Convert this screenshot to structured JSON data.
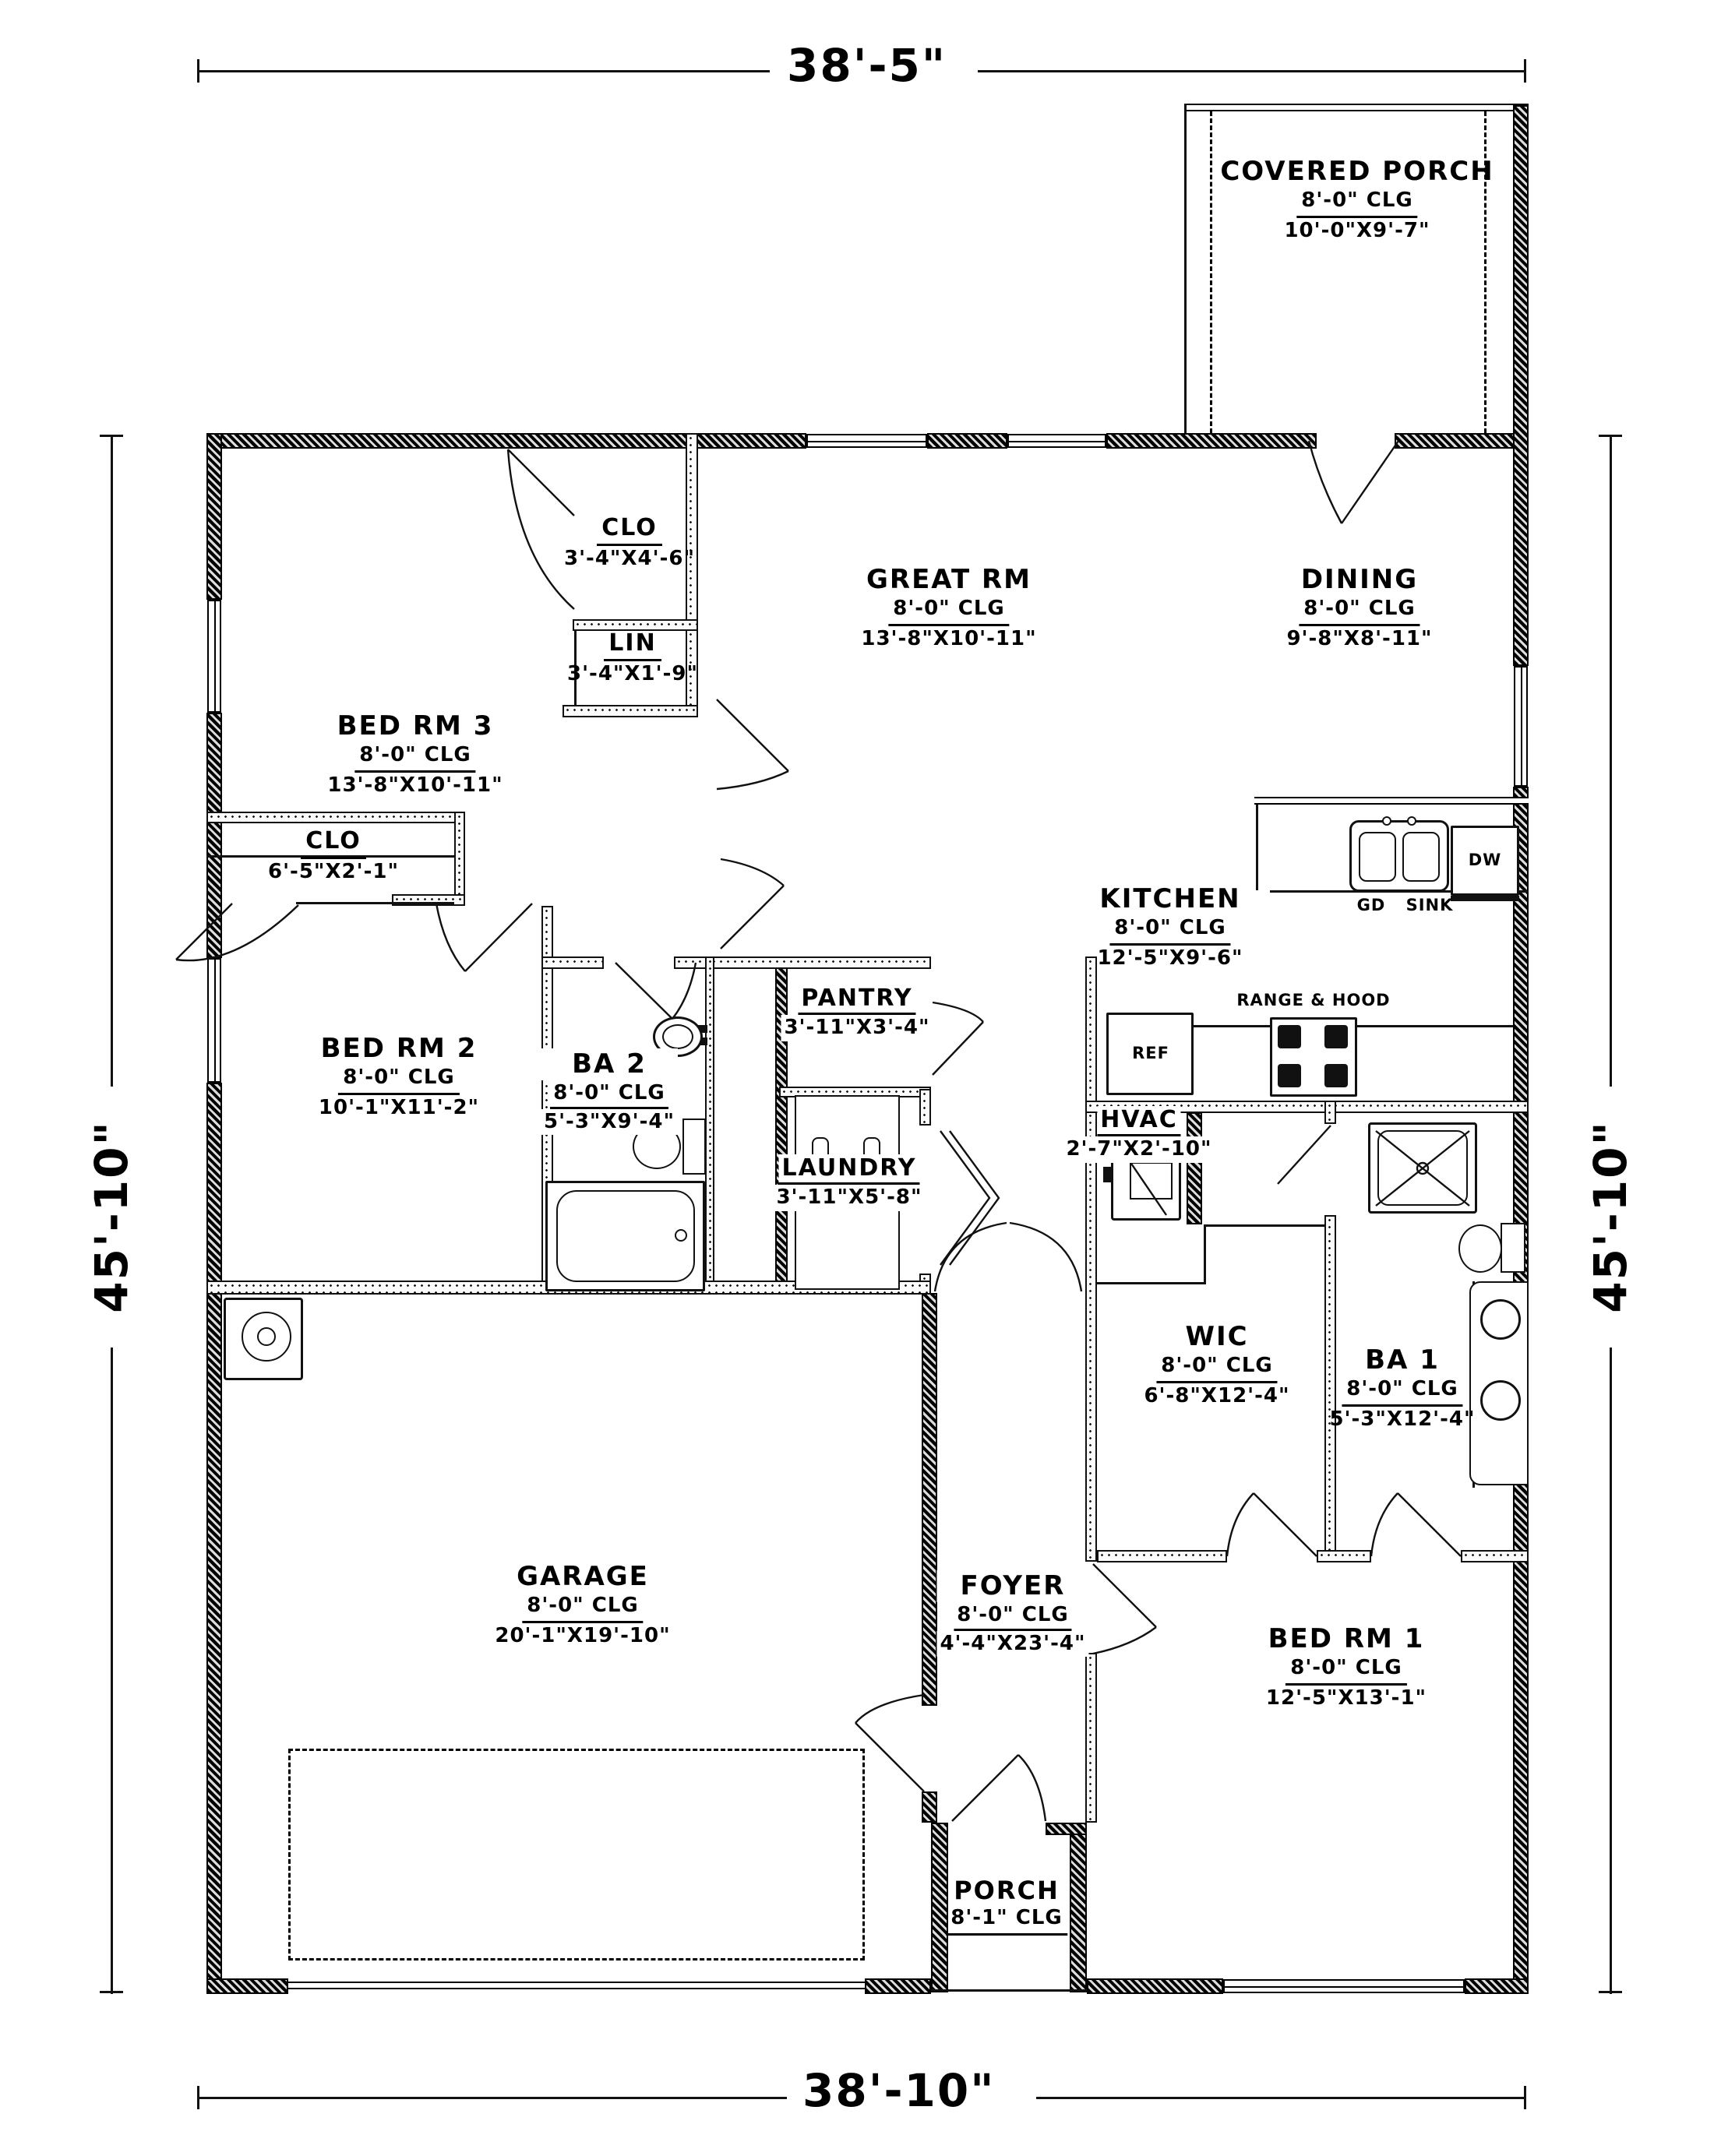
{
  "dimensions": {
    "top": "38'-5\"",
    "bottom": "38'-10\"",
    "left": "45'-10\"",
    "right": "45'-10\""
  },
  "rooms": {
    "covered_porch": {
      "name": "COVERED PORCH",
      "clg": "8'-0\" CLG",
      "size": "10'-0\"X9'-7\""
    },
    "great_rm": {
      "name": "GREAT RM",
      "clg": "8'-0\" CLG",
      "size": "13'-8\"X10'-11\""
    },
    "dining": {
      "name": "DINING",
      "clg": "8'-0\" CLG",
      "size": "9'-8\"X8'-11\""
    },
    "clo_top": {
      "name": "CLO",
      "size": "3'-4\"X4'-6\""
    },
    "lin": {
      "name": "LIN",
      "size": "3'-4\"X1'-9\""
    },
    "bed_rm_3": {
      "name": "BED RM 3",
      "clg": "8'-0\" CLG",
      "size": "13'-8\"X10'-11\""
    },
    "clo_2": {
      "name": "CLO",
      "size": "6'-5\"X2'-1\""
    },
    "bed_rm_2": {
      "name": "BED RM 2",
      "clg": "8'-0\" CLG",
      "size": "10'-1\"X11'-2\""
    },
    "ba_2": {
      "name": "BA 2",
      "clg": "8'-0\" CLG",
      "size": "5'-3\"X9'-4\""
    },
    "pantry": {
      "name": "PANTRY",
      "size": "3'-11\"X3'-4\""
    },
    "laundry": {
      "name": "LAUNDRY",
      "size": "3'-11\"X5'-8\""
    },
    "kitchen": {
      "name": "KITCHEN",
      "clg": "8'-0\" CLG",
      "size": "12'-5\"X9'-6\""
    },
    "hvac": {
      "name": "HVAC",
      "size": "2'-7\"X2'-10\""
    },
    "wic": {
      "name": "WIC",
      "clg": "8'-0\" CLG",
      "size": "6'-8\"X12'-4\""
    },
    "ba_1": {
      "name": "BA 1",
      "clg": "8'-0\" CLG",
      "size": "5'-3\"X12'-4\""
    },
    "garage": {
      "name": "GARAGE",
      "clg": "8'-0\" CLG",
      "size": "20'-1\"X19'-10\""
    },
    "foyer": {
      "name": "FOYER",
      "clg": "8'-0\" CLG",
      "size": "4'-4\"X23'-4\""
    },
    "bed_rm_1": {
      "name": "BED RM 1",
      "clg": "8'-0\" CLG",
      "size": "12'-5\"X13'-1\""
    },
    "porch": {
      "name": "PORCH",
      "clg": "8'-1\" CLG"
    }
  },
  "fixtures": {
    "gd": "GD",
    "sink": "SINK",
    "dw": "DW",
    "ref": "REF",
    "range_hood": "RANGE & HOOD"
  }
}
